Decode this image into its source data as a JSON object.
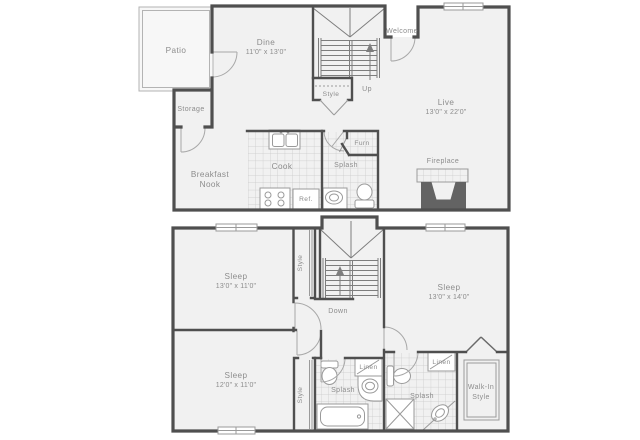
{
  "title": "Two-level apartment floor plan",
  "colors": {
    "wall": "#4f4f4f",
    "room_fill": "#f1f1f1",
    "patio_fill": "#f7f7f7",
    "label": "#8c8c8c",
    "fixture": "#9a9a9a",
    "tile_line": "#c9c9c9",
    "fireplace_masonry": "#636363",
    "background": "#ffffff"
  },
  "upper": {
    "patio": {
      "name": "Patio"
    },
    "storage": {
      "name": "Storage"
    },
    "dine": {
      "name": "Dine",
      "dims": "11'0\" x 13'0\""
    },
    "entry": {
      "name": "Welcome"
    },
    "stairs": {
      "name": "Up"
    },
    "closet": {
      "name": "Style"
    },
    "live": {
      "name": "Live",
      "dims": "13'0\" x 22'0\""
    },
    "nook": {
      "line1": "Breakfast",
      "line2": "Nook"
    },
    "kitchen": {
      "name": "Cook"
    },
    "fridge": {
      "name": "Ref."
    },
    "bath": {
      "name": "Splash"
    },
    "furnace": {
      "name": "Furn"
    },
    "fireplace": {
      "name": "Fireplace"
    }
  },
  "lower": {
    "sleep_nw": {
      "name": "Sleep",
      "dims": "13'0\" x 11'0\""
    },
    "sleep_e": {
      "name": "Sleep",
      "dims": "13'0\" x 14'0\""
    },
    "sleep_sw": {
      "name": "Sleep",
      "dims": "12'0\" x 11'0\""
    },
    "stairs": {
      "name": "Down"
    },
    "closet_n": {
      "name": "Style"
    },
    "closet_s": {
      "name": "Style"
    },
    "bath_w": {
      "name": "Splash"
    },
    "bath_e": {
      "name": "Splash"
    },
    "linen_w": {
      "name": "Linen"
    },
    "linen_e": {
      "name": "Linen"
    },
    "walk_in": {
      "line1": "Walk-In",
      "line2": "Style"
    }
  }
}
